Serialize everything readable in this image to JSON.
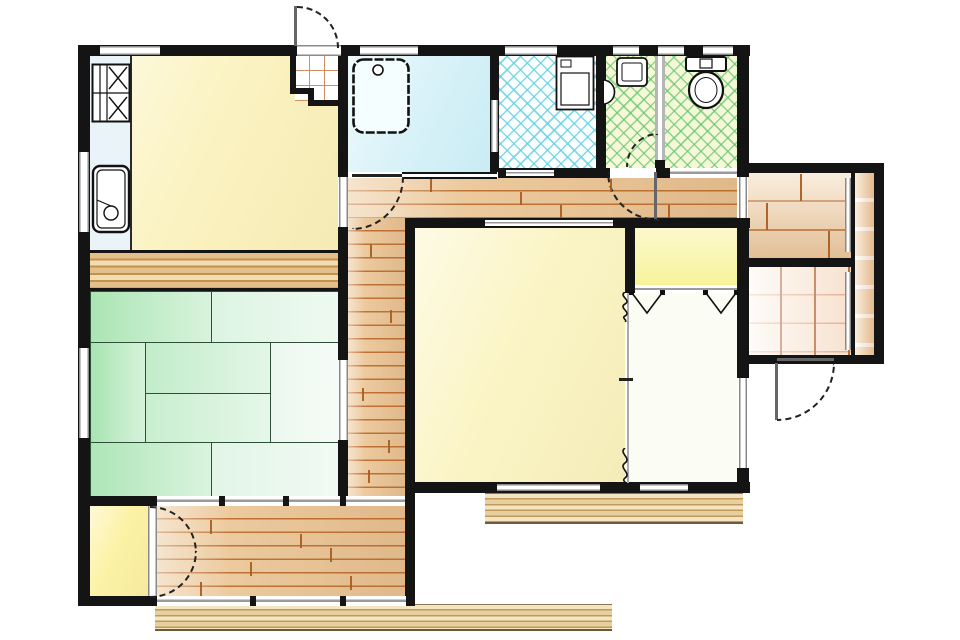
{
  "colors": {
    "wall": "#141414",
    "door_arc": "#222222",
    "plank_line": "#ba6a2a",
    "tile_cyan": "#5fd0e2",
    "tile_green": "#62c46c",
    "grid_line": "#a85a28",
    "deck_stripe": "#c09a5c"
  },
  "rooms": {
    "kitchen_dining": {
      "fill": "#fbf3c2",
      "floor": "sheet"
    },
    "kitchen_counter": {
      "fill": "#eaf4f8",
      "floor": "counter"
    },
    "entry_genkan": {
      "fill": "#ffffff",
      "floor": "tile-grid"
    },
    "bathroom": {
      "fill": "#d8f2f8",
      "floor": "wet"
    },
    "laundry_room": {
      "fill": "#fcffff",
      "floor": "tile-diamond-cyan"
    },
    "washbasin_room": {
      "fill": "#f6f8d8",
      "floor": "tile-diamond-green"
    },
    "toilet_room": {
      "fill": "#f4f8d6",
      "floor": "tile-diamond-green"
    },
    "hallway": {
      "fill": "#ecca9e",
      "floor": "wood-planks"
    },
    "tatami_room": {
      "mats": [
        "#abe5b4",
        "#ddf4e2",
        "#a8e4b1",
        "#c2ecca",
        "#c8eecf",
        "#ecf8ef",
        "#aee6b7",
        "#e2f5e7"
      ],
      "floor": "tatami-8"
    },
    "oshiire_closet": {
      "fill": "#e0b77f",
      "floor": "wood-boards"
    },
    "main_room": {
      "fill": "#fbf5c6",
      "floor": "sheet"
    },
    "closet": {
      "fill": "#f8f39a",
      "floor": "sheet"
    },
    "second_room": {
      "fill": "#fbfcf3",
      "floor": "sheet"
    },
    "rear_room_upper": {
      "fill": "#f3d8b4",
      "floor": "wood-planks-wide"
    },
    "rear_room_lower": {
      "fill": "#fdf4ec",
      "floor": "tile-grid"
    },
    "side_veranda": {
      "fill": "#f2d2ac",
      "floor": "tile-strip"
    },
    "storage_room": {
      "fill": "#fcf2a6",
      "floor": "sheet"
    },
    "rear_hall_room": {
      "fill": "#ecca9e",
      "floor": "wood-planks"
    },
    "deck_front": {
      "fill": "#e8cf9e",
      "floor": "deck-boards"
    },
    "deck_side": {
      "fill": "#e8cf9e",
      "floor": "deck-boards"
    }
  },
  "fixtures": [
    "gas-stove",
    "kitchen-sink",
    "bathtub",
    "washing-machine",
    "wash-basin",
    "corner-basin",
    "toilet"
  ],
  "symbols": {
    "swing_doors": 6,
    "sliding_panels": 9,
    "bifold_closet_marks": 2,
    "open_partition_squiggles": 2
  }
}
